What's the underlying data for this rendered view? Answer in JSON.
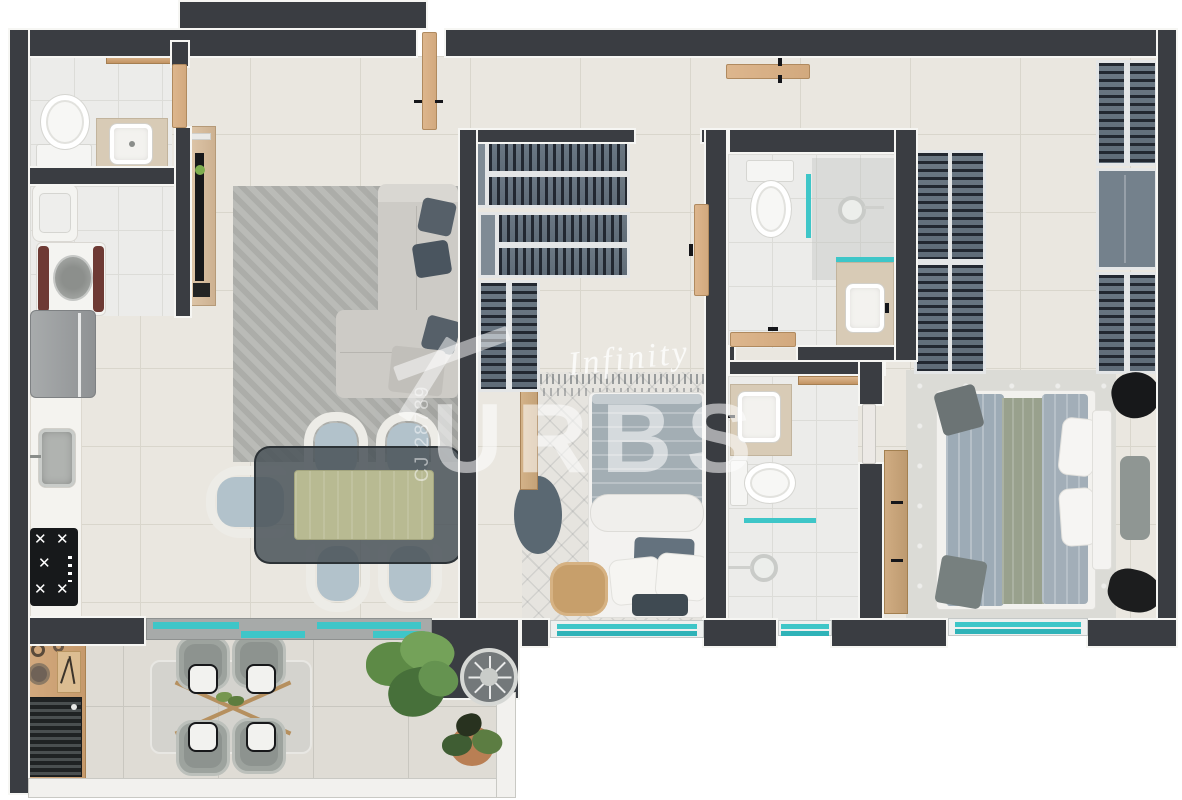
{
  "watermark": {
    "script": "Infinity",
    "brand": "URBS",
    "registration": "CJ 28789"
  },
  "palette": {
    "wall": "#3a3d42",
    "floor": "#eae7e0",
    "bathroom_floor": "#ececea",
    "balcony_floor": "#dfdcd5",
    "accent_glass": "#3ec6c8",
    "wood": "#d2a97e",
    "wardrobe": "#6b7884",
    "rug_living": "#b5b6b2",
    "sofa": "#cdcbc6",
    "dining_table": "#4a5258",
    "runner": "#b8ba92",
    "background": "#ffffff"
  }
}
